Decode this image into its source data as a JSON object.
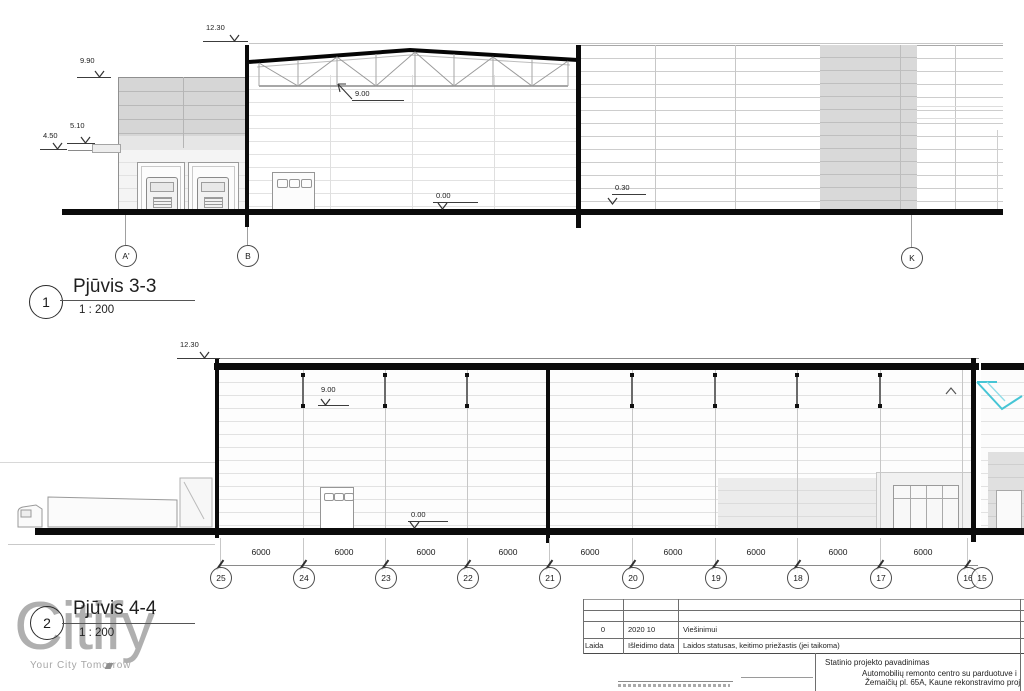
{
  "watermark": {
    "brand": "Citify",
    "tagline": "Your City Tomorrow"
  },
  "s1": {
    "callout_number": "1",
    "title": "Pjūvis 3-3",
    "scale": "1 : 200",
    "levels": {
      "top": "12.30",
      "left_roof": "9.90",
      "canopy": "5.10",
      "canopy_low": "4.50",
      "truss": "9.00",
      "floor": "0.00",
      "yard": "0.30"
    },
    "grids": {
      "a1": "A'",
      "b": "B",
      "k": "K"
    }
  },
  "s2": {
    "callout_number": "2",
    "title": "Pjūvis 4-4",
    "scale": "1 : 200",
    "levels": {
      "top": "12.30",
      "mid": "9.00",
      "floor": "0.00"
    },
    "dims": [
      "6000",
      "6000",
      "6000",
      "6000",
      "6000",
      "6000",
      "6000",
      "6000",
      "6000"
    ],
    "grids": [
      "25",
      "24",
      "23",
      "22",
      "21",
      "20",
      "19",
      "18",
      "17",
      "16",
      "15"
    ]
  },
  "titleblock": {
    "rev_value": "0",
    "rev_date": "2020 10",
    "rev_status": "Viešinimui",
    "col_laida": "Laida",
    "col_date": "Išleidimo data",
    "col_status": "Laidos statusas, keitimo priežastis (jei taikoma)",
    "project_label": "Statinio projekto pavadinimas",
    "project_name_line1": "Automobilių remonto centro su  parduotuve i",
    "project_name_line2": "Žemaičių pl. 65A, Kaune rekonstravimo proj"
  },
  "colors": {
    "line_black": "#0b0b0b",
    "shade_gray": "#d9d9d9",
    "accent_cyan": "#46c5d5"
  }
}
